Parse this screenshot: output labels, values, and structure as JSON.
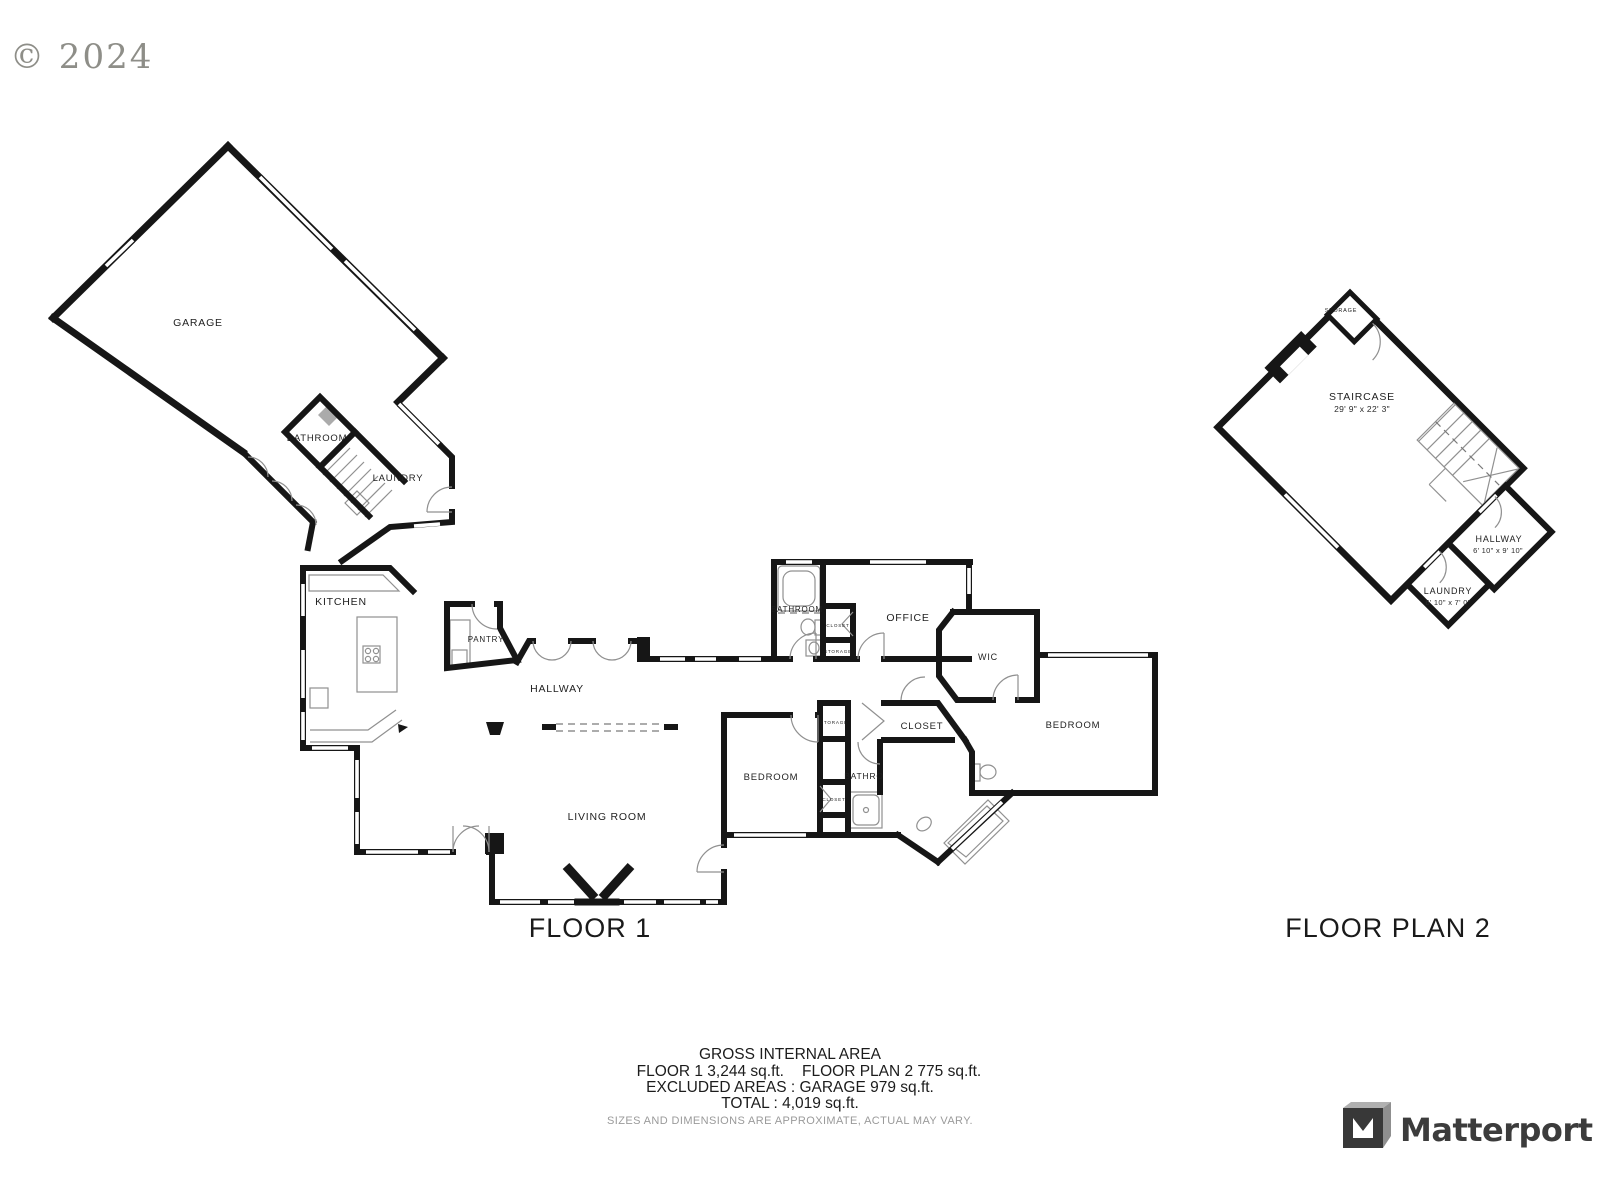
{
  "copyright": "© 2024",
  "floor1": {
    "title": "FLOOR 1",
    "rooms": {
      "garage": "GARAGE",
      "bathroom": "BATHROOM",
      "laundry": "LAUNDRY",
      "kitchen": "KITCHEN",
      "pantry": "PANTRY",
      "hallway": "HALLWAY",
      "living_room": "LIVING ROOM",
      "bathroom2": "BATHROOM",
      "closet_a": "CLOSET",
      "storage_a": "STORAGE",
      "office": "OFFICE",
      "wic": "WIC",
      "closet_b": "CLOSET",
      "bedroom_right": "BEDROOM",
      "bedroom_left": "BEDROOM",
      "storage_b": "STORAGE",
      "closet_c": "CLOSET",
      "bathroom3": "BATHRO"
    }
  },
  "floor2": {
    "title": "FLOOR PLAN 2",
    "rooms": {
      "storage": "STORAGE",
      "staircase": {
        "label": "STAIRCASE",
        "dims": "29' 9\" x 22' 3\""
      },
      "hallway": {
        "label": "HALLWAY",
        "dims": "6' 10\" x 9' 10\""
      },
      "laundry": {
        "label": "LAUNDRY",
        "dims": "6' 10\" x 7' 0\""
      }
    }
  },
  "summary": {
    "heading": "GROSS INTERNAL AREA",
    "floor1_area": "FLOOR 1 3,244 sq.ft.",
    "floor2_area": "FLOOR PLAN 2 775 sq.ft.",
    "excluded": "EXCLUDED AREAS :  GARAGE 979 sq.ft.",
    "total": "TOTAL :  4,019 sq.ft.",
    "disclaimer": "SIZES AND DIMENSIONS ARE APPROXIMATE, ACTUAL MAY VARY."
  },
  "branding": {
    "logo_text": "Matterport"
  },
  "colors": {
    "wall": "#161616",
    "accent_gray": "#8e8e88",
    "logo": "#3c3c3c"
  }
}
